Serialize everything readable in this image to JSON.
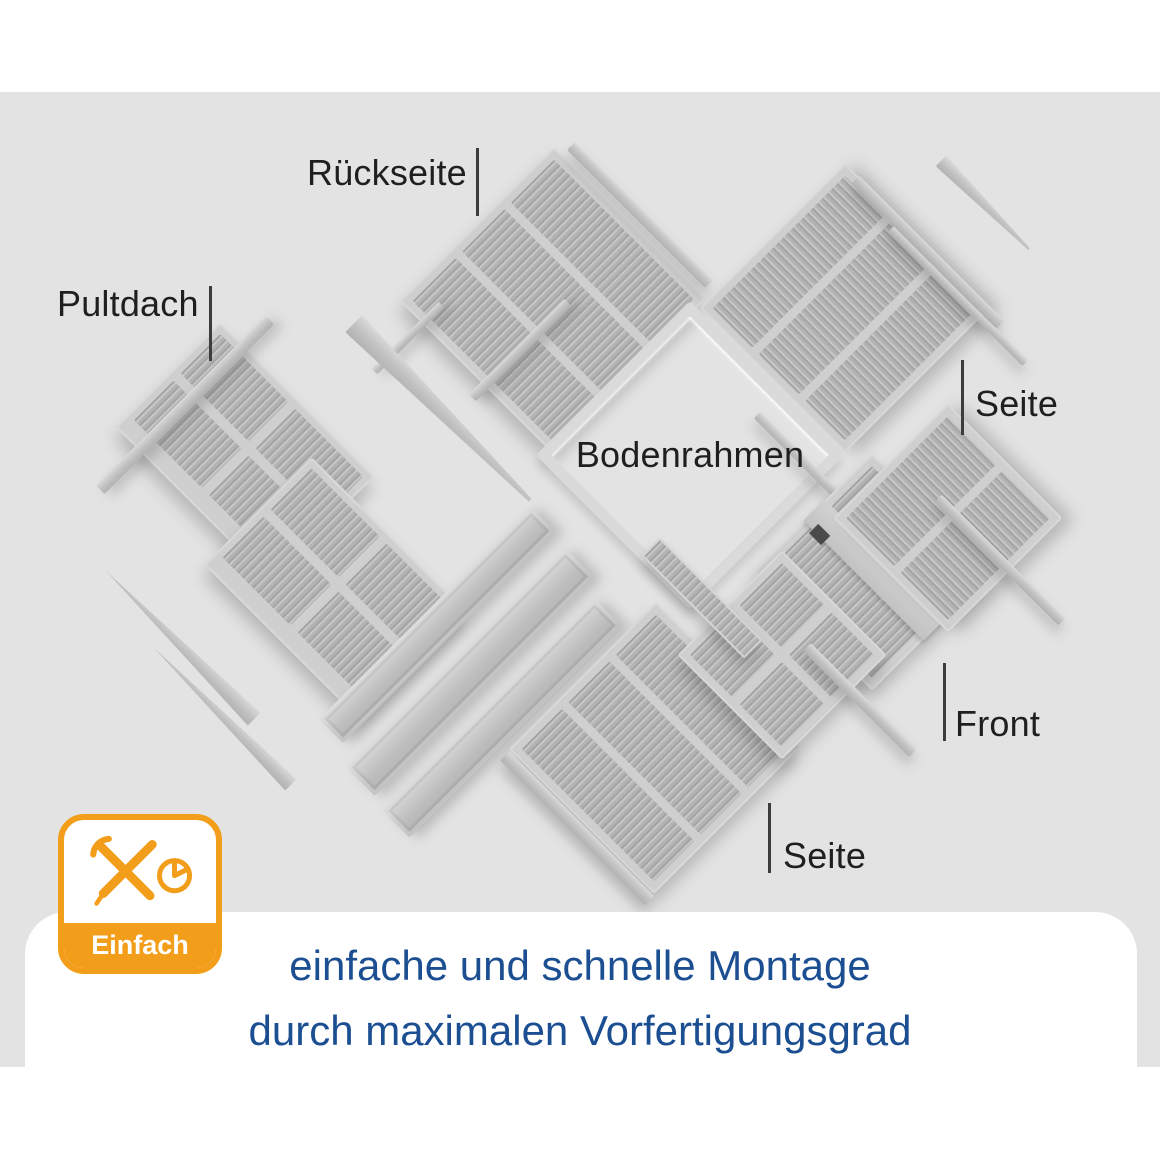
{
  "colors": {
    "canvas_bg": "#e3e3e3",
    "page_bg": "#ffffff",
    "accent_orange": "#F29E1A",
    "caption_blue": "#1C4E92",
    "label_dark": "#1f1f1f",
    "part_gray": "#c7c7c7"
  },
  "diagram": {
    "labels": {
      "back": "Rückseite",
      "roof": "Pultdach",
      "floor": "Bodenrahmen",
      "side_right": "Seite",
      "front": "Front",
      "side_bottom": "Seite"
    }
  },
  "badge": {
    "label": "Einfach",
    "icons": [
      "wrench-icon",
      "screwdriver-icon",
      "pie-clock-icon"
    ]
  },
  "caption": {
    "line1": "einfache und schnelle Montage",
    "line2": "durch maximalen Vorfertigungsgrad"
  }
}
